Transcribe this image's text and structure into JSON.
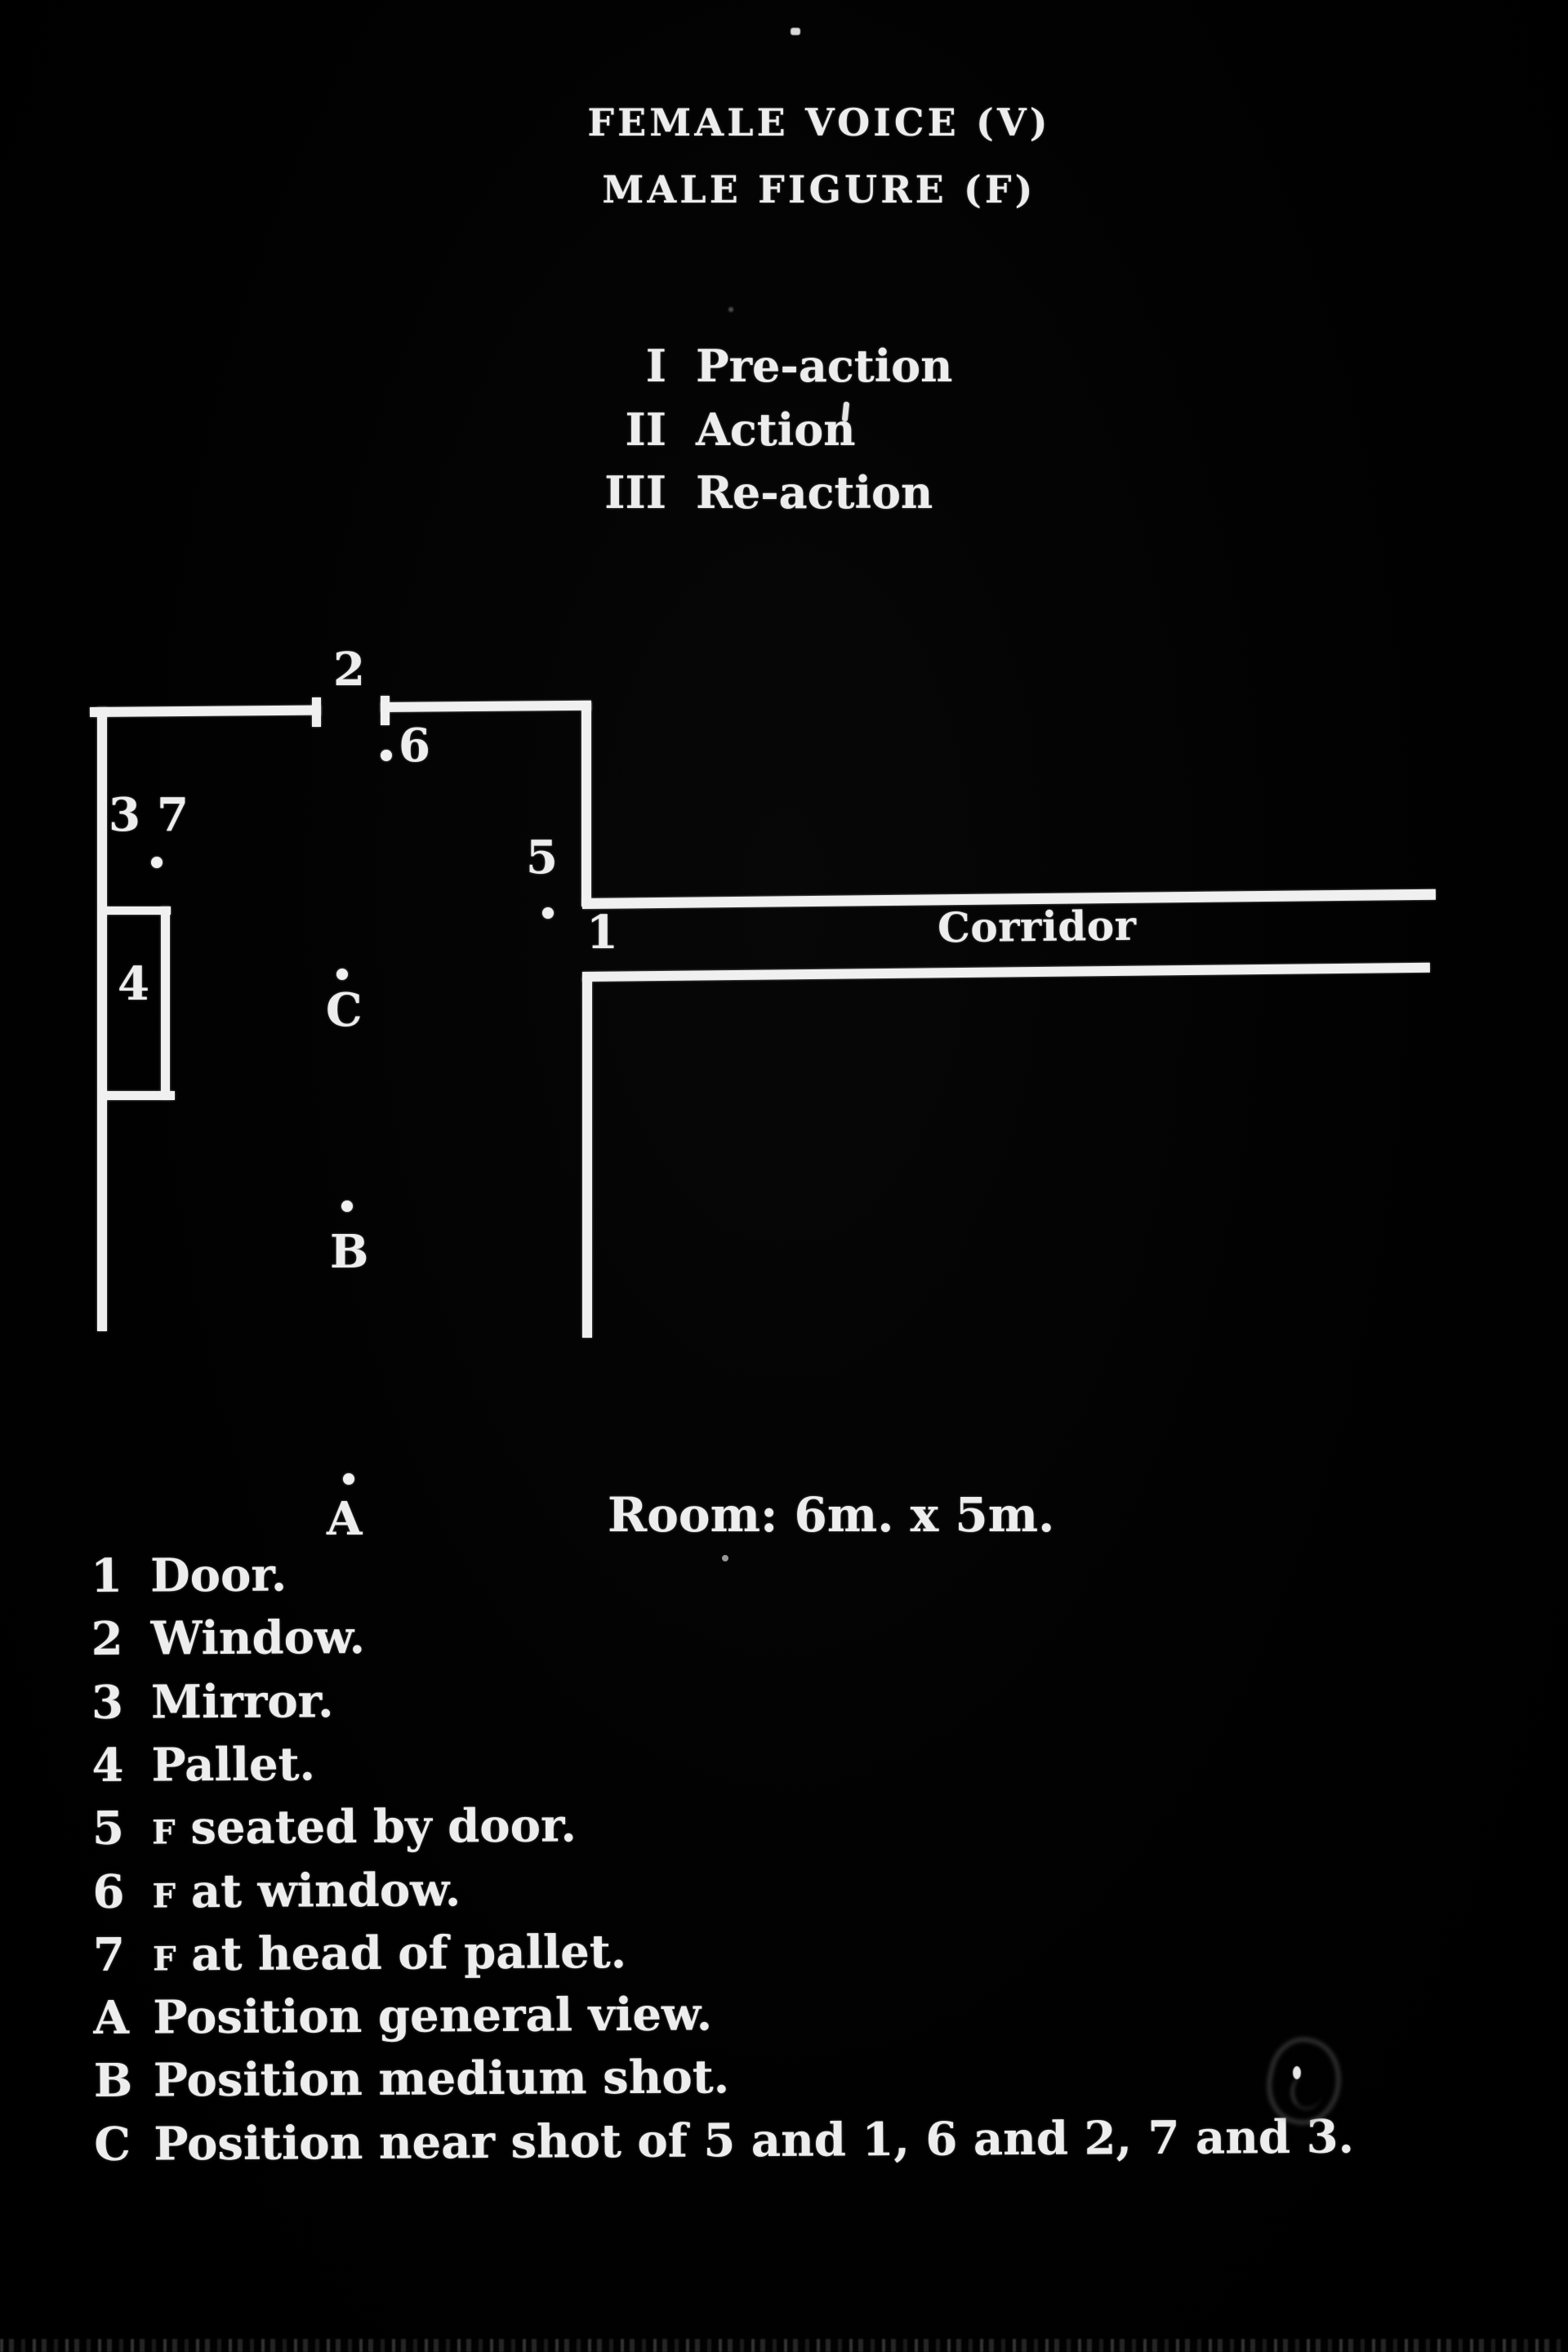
{
  "page": {
    "background": "#000000",
    "ink": "#ededed"
  },
  "header": {
    "line1": "FEMALE VOICE (V)",
    "line2": "MALE FIGURE (F)"
  },
  "sections": [
    {
      "numeral": "I",
      "label": "Pre-action"
    },
    {
      "numeral": "II",
      "label": "Action"
    },
    {
      "numeral": "III",
      "label": "Re-action"
    }
  ],
  "diagram": {
    "labels": {
      "n1": "1",
      "n2": "2",
      "n3": "3",
      "n4": "4",
      "n5": "5",
      "n6": "6",
      "n7": "7",
      "posA": "A",
      "posB": "B",
      "posC": "C",
      "corridor": "Corridor",
      "room_size": "Room: 6m. x 5m."
    }
  },
  "legend": {
    "items": [
      {
        "key": "1",
        "text": "Door."
      },
      {
        "key": "2",
        "text": "Window."
      },
      {
        "key": "3",
        "text": "Mirror."
      },
      {
        "key": "4",
        "text": "Pallet."
      },
      {
        "key": "5",
        "f": "F",
        "text": "seated by door."
      },
      {
        "key": "6",
        "f": "F",
        "text": "at window."
      },
      {
        "key": "7",
        "f": "F",
        "text": "at head of pallet."
      },
      {
        "key": "A",
        "text": "Position general view."
      },
      {
        "key": "B",
        "text": "Position medium shot."
      },
      {
        "key": "C",
        "text": "Position near shot of 5 and 1, 6 and 2, 7 and 3."
      }
    ]
  }
}
